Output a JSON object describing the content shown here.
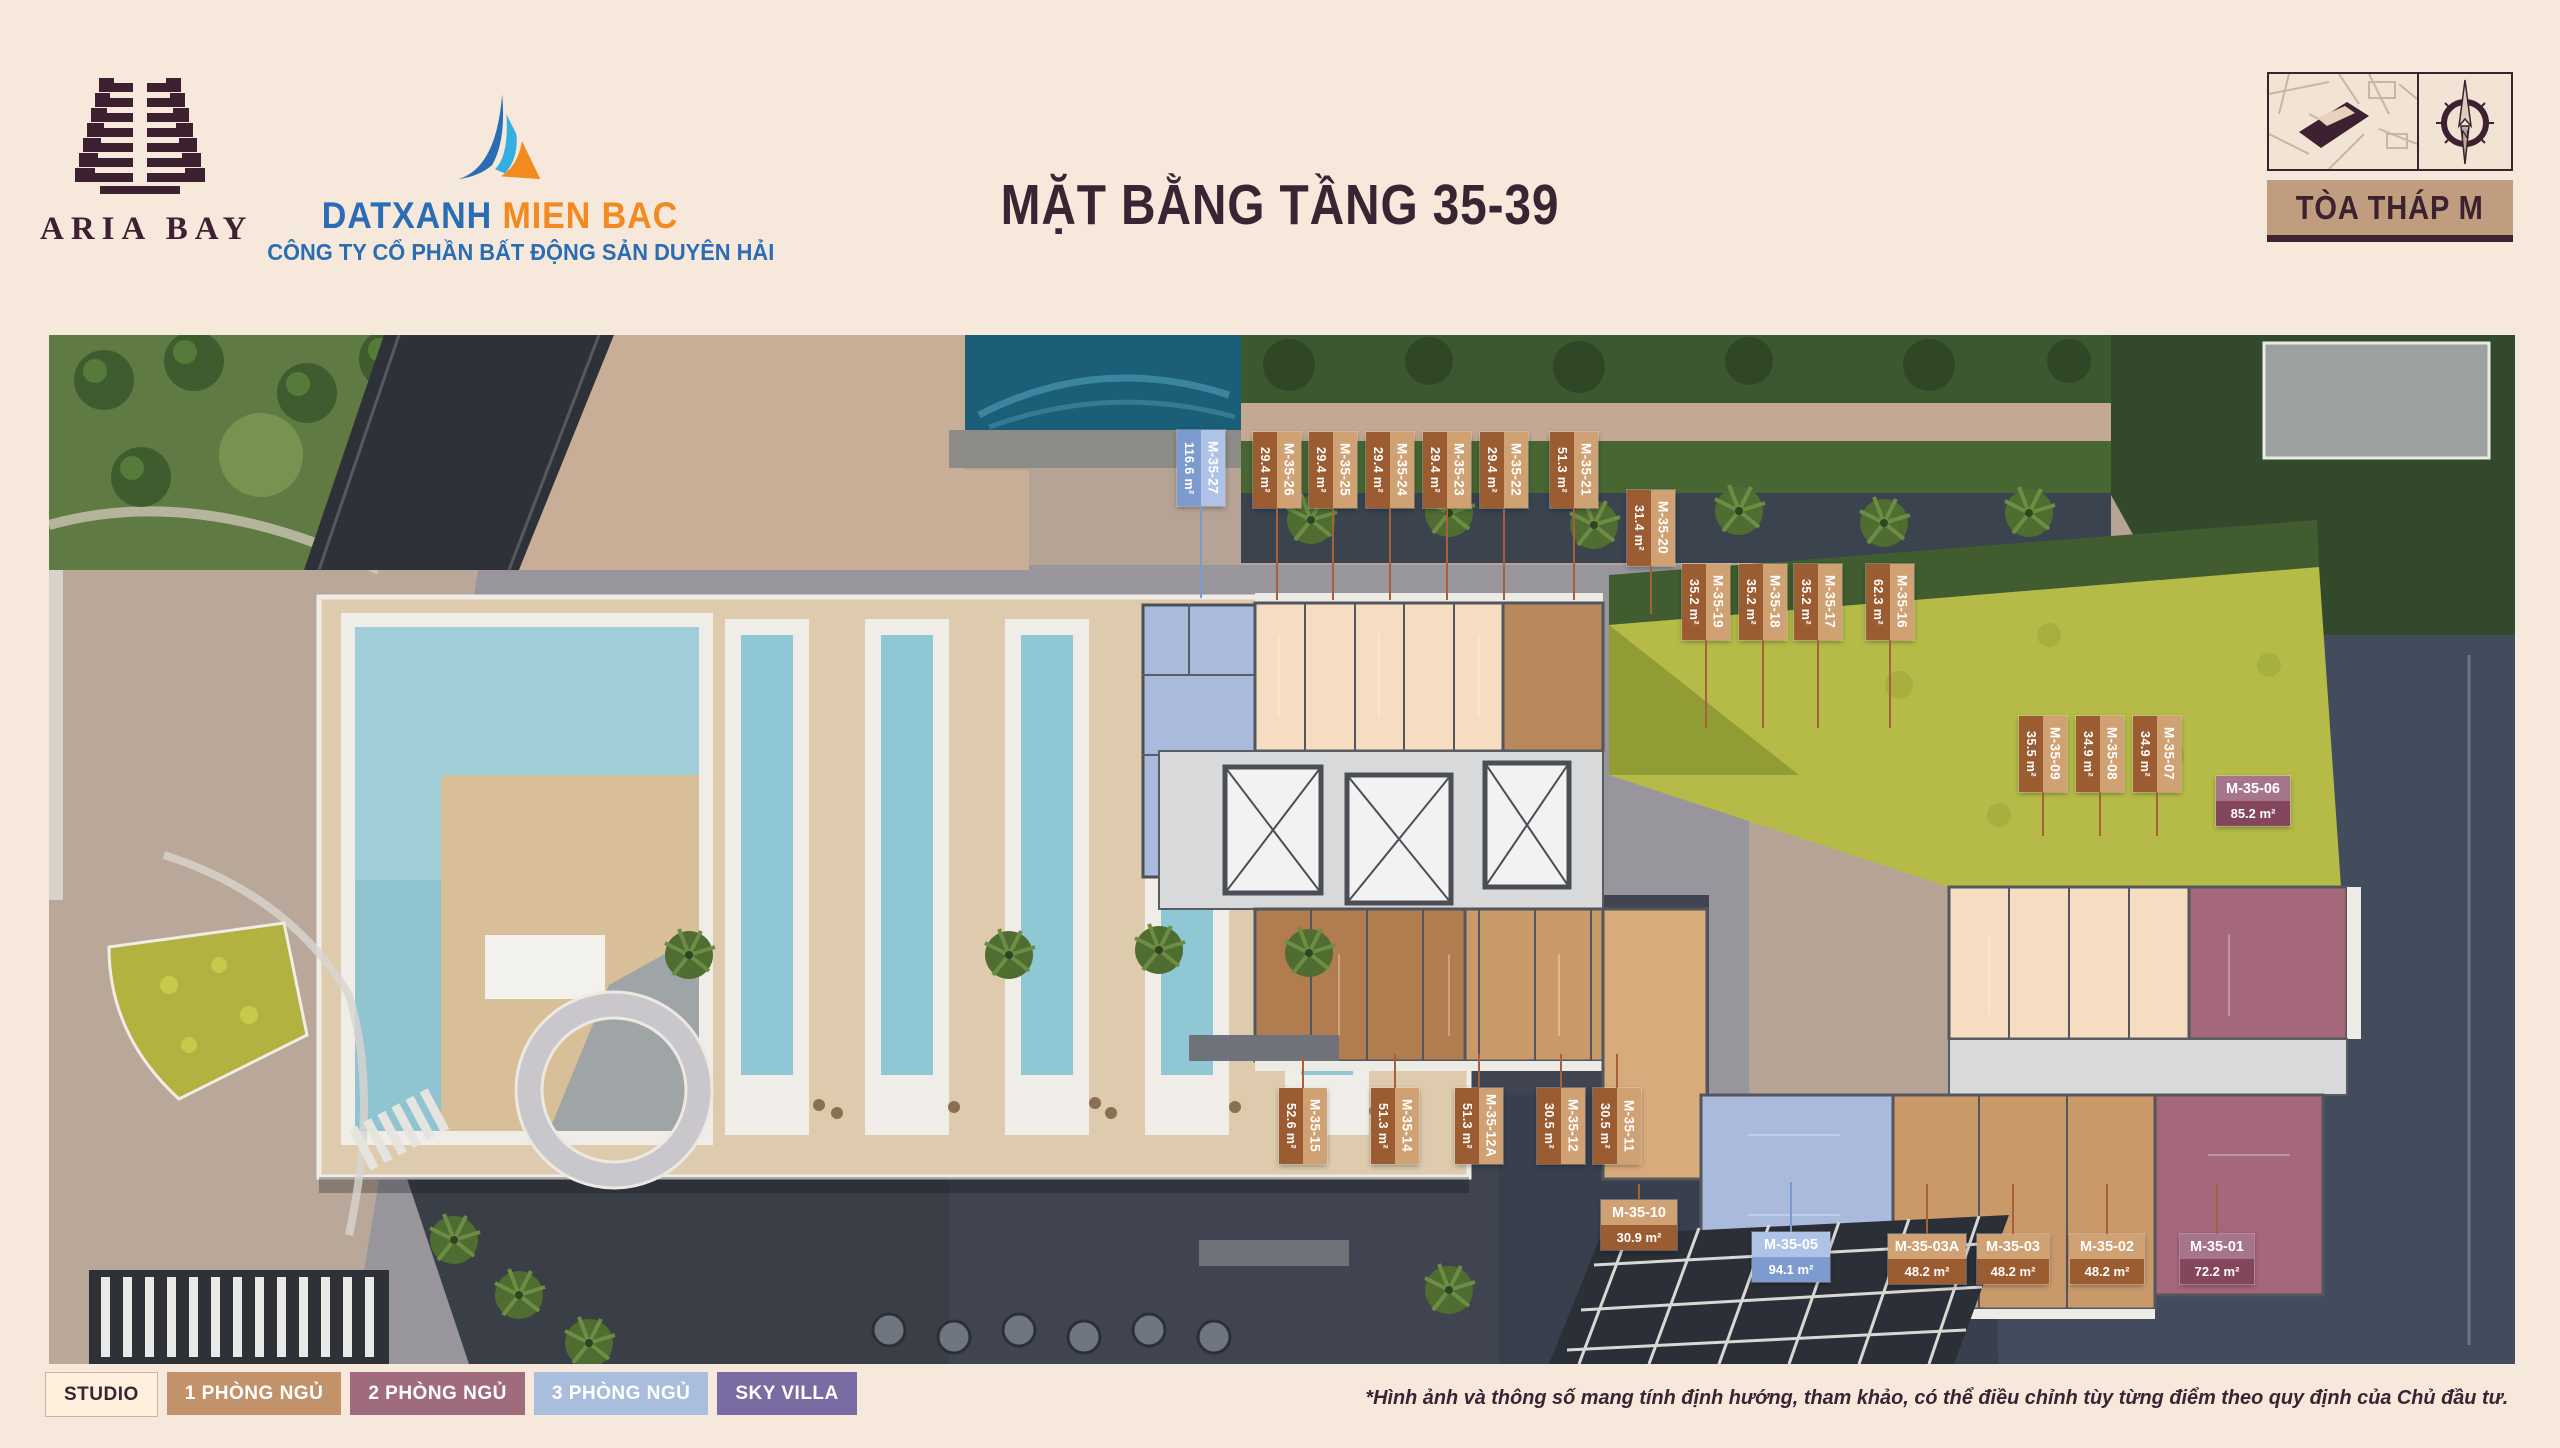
{
  "header": {
    "brand_name": "ARIA BAY",
    "agency_name_primary": "DATXANH",
    "agency_name_secondary": "MIEN BAC",
    "agency_company": "CÔNG TY CỔ PHẦN BẤT ĐỘNG SẢN DUYÊN HẢI",
    "title": "MẶT BẰNG TẦNG 35-39",
    "tower_badge": "TÒA THÁP M",
    "compass_letter": "N"
  },
  "colors": {
    "page_bg": "#f6e9dc",
    "maroon": "#3a2433",
    "label_tan_light": "#d0a173",
    "label_tan_dark": "#9c5c31",
    "label_blue_light": "#afc3e6",
    "label_blue_dark": "#7e9bd0",
    "label_mauve_light": "#a7758b",
    "label_mauve_dark": "#83465c",
    "leader_line": "#a4613a"
  },
  "legend": {
    "items": [
      {
        "label": "STUDIO",
        "bg": "#fdf0dd",
        "fg": "#3a2433"
      },
      {
        "label": "1 PHÒNG NGỦ",
        "bg": "#c2936a",
        "fg": "#ffffff"
      },
      {
        "label": "2 PHÒNG NGỦ",
        "bg": "#a06b7c",
        "fg": "#ffffff"
      },
      {
        "label": "3 PHÒNG NGỦ",
        "bg": "#a9bedd",
        "fg": "#ffffff"
      },
      {
        "label": "SKY VILLA",
        "bg": "#7a6ba3",
        "fg": "#ffffff"
      }
    ]
  },
  "disclaimer": "*Hình ảnh và thông số mang tính định hướng, tham khảo, có thể điều chỉnh tùy từng điểm theo quy định của Chủ đầu tư.",
  "units": [
    {
      "id": "M-35-27",
      "area": "116.6 m²",
      "style": "blue"
    },
    {
      "id": "M-35-26",
      "area": "29.4 m²",
      "style": "tan"
    },
    {
      "id": "M-35-25",
      "area": "29.4 m²",
      "style": "tan"
    },
    {
      "id": "M-35-24",
      "area": "29.4 m²",
      "style": "tan"
    },
    {
      "id": "M-35-23",
      "area": "29.4 m²",
      "style": "tan"
    },
    {
      "id": "M-35-22",
      "area": "29.4 m²",
      "style": "tan"
    },
    {
      "id": "M-35-21",
      "area": "51.3 m²",
      "style": "tan"
    },
    {
      "id": "M-35-20",
      "area": "31.4 m²",
      "style": "tan"
    },
    {
      "id": "M-35-19",
      "area": "35.2 m²",
      "style": "tan"
    },
    {
      "id": "M-35-18",
      "area": "35.2 m²",
      "style": "tan"
    },
    {
      "id": "M-35-17",
      "area": "35.2 m²",
      "style": "tan"
    },
    {
      "id": "M-35-16",
      "area": "62.3 m²",
      "style": "tan"
    },
    {
      "id": "M-35-09",
      "area": "35.5 m²",
      "style": "tan"
    },
    {
      "id": "M-35-08",
      "area": "34.9 m²",
      "style": "tan"
    },
    {
      "id": "M-35-07",
      "area": "34.9 m²",
      "style": "tan"
    },
    {
      "id": "M-35-06",
      "area": "85.2 m²",
      "style": "mauve"
    },
    {
      "id": "M-35-15",
      "area": "52.6 m²",
      "style": "tan"
    },
    {
      "id": "M-35-14",
      "area": "51.3 m²",
      "style": "tan"
    },
    {
      "id": "M-35-12A",
      "area": "51.3 m²",
      "style": "tan"
    },
    {
      "id": "M-35-12",
      "area": "30.5 m²",
      "style": "tan"
    },
    {
      "id": "M-35-11",
      "area": "30.5 m²",
      "style": "tan"
    },
    {
      "id": "M-35-10",
      "area": "30.9 m²",
      "style": "tan"
    },
    {
      "id": "M-35-05",
      "area": "94.1 m²",
      "style": "blue"
    },
    {
      "id": "M-35-03A",
      "area": "48.2 m²",
      "style": "tan"
    },
    {
      "id": "M-35-03",
      "area": "48.2 m²",
      "style": "tan"
    },
    {
      "id": "M-35-02",
      "area": "48.2 m²",
      "style": "tan"
    },
    {
      "id": "M-35-01",
      "area": "72.2 m²",
      "style": "mauve"
    }
  ]
}
